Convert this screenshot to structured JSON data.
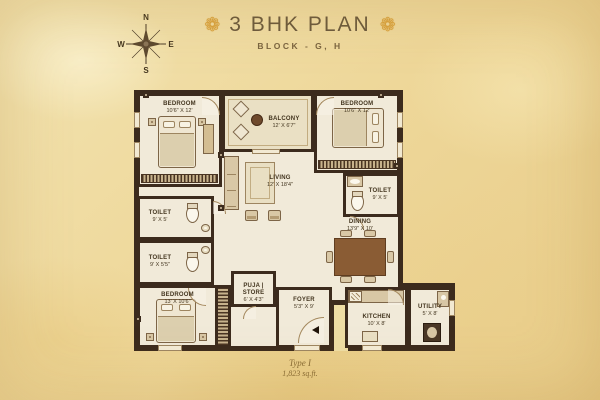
{
  "title": {
    "text": "3 BHK PLAN",
    "subtitle": "BLOCK - G, H",
    "ornament_char": "❁"
  },
  "compass": {
    "north": "N",
    "east": "E",
    "south": "S",
    "west": "W"
  },
  "caption": {
    "type_label": "Type I",
    "area_label": "1,823 sq.ft."
  },
  "colors": {
    "wall": "#3c2b1d",
    "floor": "#f1ead9",
    "parchment": "#eed799",
    "accent_gold": "#d8a03a",
    "label_text": "#43351f"
  },
  "rooms": {
    "bedroom_tl": {
      "name": "BEDROOM",
      "dims": "10'6\" X 12'"
    },
    "balcony": {
      "name": "BALCONY",
      "dims": "12' X 6'7\""
    },
    "bedroom_tr": {
      "name": "BEDROOM",
      "dims": "10'6\" X 12'"
    },
    "living": {
      "name": "LIVING",
      "dims": "12' X 18'4\""
    },
    "toilet_left_top": {
      "name": "TOILET",
      "dims": "9' X 5'"
    },
    "toilet_left_bottom": {
      "name": "TOILET",
      "dims": "9' X 5'5\""
    },
    "toilet_right": {
      "name": "TOILET",
      "dims": "9' X 5'"
    },
    "dining": {
      "name": "DINING",
      "dims": "13'9\" X 10'"
    },
    "bedroom_bl": {
      "name": "BEDROOM",
      "dims": "13' X 10'6\""
    },
    "puja": {
      "name": "PUJA | STORE",
      "dims": "6' X 4'3\""
    },
    "foyer": {
      "name": "FOYER",
      "dims": "5'3\" X 9'"
    },
    "kitchen": {
      "name": "KITCHEN",
      "dims": "10' X 8'"
    },
    "utility": {
      "name": "UTILITY",
      "dims": "5' X 8'"
    }
  }
}
